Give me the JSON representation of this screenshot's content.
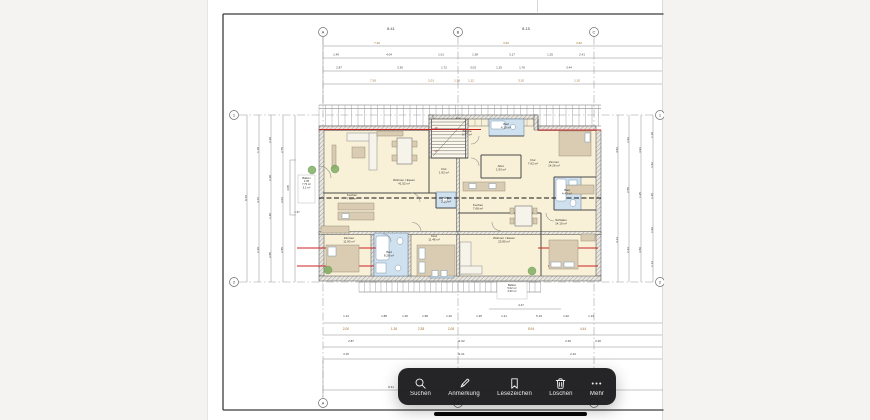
{
  "colors": {
    "background": "#f4f3f1",
    "sheet": "#ffffff",
    "toolbar": "rgba(28,28,30,0.96)",
    "accent_red": "#cc2222",
    "room_cream": "#f8f1d8",
    "bath_blue": "#cfe0ee",
    "furniture_tan": "#d9ccb2",
    "plant_green": "#7fae62",
    "dim_orange": "#a06a28"
  },
  "toolbar": {
    "buttons": [
      {
        "icon": "search-icon",
        "label": "Suchen"
      },
      {
        "icon": "pencil-icon",
        "label": "Anmerkung"
      },
      {
        "icon": "bookmark-icon",
        "label": "Lesezeichen"
      },
      {
        "icon": "trash-icon",
        "label": "Löschen"
      },
      {
        "icon": "ellipsis-icon",
        "label": "Mehr"
      }
    ]
  },
  "drawing": {
    "grid_markers": [
      {
        "x": 322,
        "y": 32,
        "t": "A"
      },
      {
        "x": 457,
        "y": 32,
        "t": "B"
      },
      {
        "x": 593,
        "y": 32,
        "t": "C"
      },
      {
        "x": 322,
        "y": 403,
        "t": "A"
      },
      {
        "x": 457,
        "y": 403,
        "t": "B"
      },
      {
        "x": 593,
        "y": 403,
        "t": "C"
      },
      {
        "x": 233,
        "y": 115,
        "t": "1"
      },
      {
        "x": 233,
        "y": 282,
        "t": "2"
      },
      {
        "x": 659,
        "y": 115,
        "t": "1"
      },
      {
        "x": 659,
        "y": 282,
        "t": "2"
      }
    ],
    "dim_rows": [
      {
        "y": 30,
        "s": 4,
        "items": [
          [
            390,
            "8.41"
          ],
          [
            525,
            "8.15"
          ]
        ]
      },
      {
        "y": 44,
        "s": 3,
        "c": "#a06a28",
        "items": [
          [
            376,
            "7.26"
          ],
          [
            505,
            "3.62"
          ],
          [
            578,
            "3.52"
          ]
        ]
      },
      {
        "y": 55.5,
        "s": 3,
        "items": [
          [
            335,
            "1.49"
          ],
          [
            388,
            "4.04"
          ],
          [
            440,
            "1.01"
          ],
          [
            474,
            "1.38"
          ],
          [
            511,
            "3.17"
          ],
          [
            549,
            "1.25"
          ],
          [
            581,
            "2.41"
          ]
        ]
      },
      {
        "y": 68.5,
        "s": 3,
        "items": [
          [
            338,
            "2.87"
          ],
          [
            399,
            "2.36"
          ],
          [
            443,
            "1.72"
          ],
          [
            472,
            "3.03"
          ],
          [
            498,
            "1.25"
          ],
          [
            521,
            "1.76"
          ],
          [
            568,
            "3.44"
          ]
        ]
      },
      {
        "y": 81.5,
        "s": 3,
        "c": "#a06a28",
        "items": [
          [
            372,
            "7.26"
          ],
          [
            430,
            "2.01"
          ],
          [
            456,
            "1.38"
          ],
          [
            470,
            "1.12"
          ],
          [
            520,
            "3.10"
          ],
          [
            576,
            "1.10"
          ]
        ]
      },
      {
        "y": 213,
        "s": 2.8,
        "items": [
          [
            296,
            "1.37"
          ]
        ]
      },
      {
        "y": 306,
        "s": 3,
        "items": [
          [
            520,
            "4.47"
          ]
        ]
      },
      {
        "y": 317,
        "s": 3,
        "items": [
          [
            345,
            "1.13"
          ],
          [
            383,
            "1.88"
          ],
          [
            404,
            "1.26"
          ],
          [
            424,
            "1.68"
          ],
          [
            448,
            "1.32"
          ],
          [
            478,
            "1.35"
          ],
          [
            503,
            "1.21"
          ],
          [
            538,
            "5.19"
          ],
          [
            565,
            "1.62"
          ],
          [
            590,
            "1.13"
          ]
        ]
      },
      {
        "y": 330,
        "s": 3.2,
        "c": "#a06a28",
        "items": [
          [
            345,
            "2.00"
          ],
          [
            393,
            "1.26"
          ],
          [
            420,
            "2.38"
          ],
          [
            450,
            "2.08"
          ],
          [
            530,
            "5.94"
          ],
          [
            582,
            "4.44"
          ]
        ]
      },
      {
        "y": 342,
        "s": 3,
        "items": [
          [
            350,
            "2.87"
          ],
          [
            460,
            "11.62"
          ],
          [
            567,
            "2.26"
          ],
          [
            597,
            "3.26"
          ]
        ]
      },
      {
        "y": 355,
        "s": 3,
        "items": [
          [
            345,
            "3.15"
          ],
          [
            460,
            "11.01"
          ],
          [
            572,
            "2.22"
          ]
        ]
      },
      {
        "y": 388,
        "s": 3,
        "items": [
          [
            390,
            "8.41"
          ]
        ]
      }
    ],
    "rotated_dims": [
      {
        "x": 246,
        "y": 198,
        "t": "8.76"
      },
      {
        "x": 258,
        "y": 150,
        "t": "1.18"
      },
      {
        "x": 258,
        "y": 200,
        "t": "4.72"
      },
      {
        "x": 258,
        "y": 250,
        "t": "2.36"
      },
      {
        "x": 270,
        "y": 140,
        "t": "2.18"
      },
      {
        "x": 270,
        "y": 178,
        "t": "2.38"
      },
      {
        "x": 270,
        "y": 216,
        "t": "1.40"
      },
      {
        "x": 270,
        "y": 255,
        "t": "2.55"
      },
      {
        "x": 282,
        "y": 150,
        "t": "2.75"
      },
      {
        "x": 282,
        "y": 200,
        "t": "2.03"
      },
      {
        "x": 282,
        "y": 250,
        "t": "2.55"
      },
      {
        "x": 288,
        "y": 188,
        "t": "4.05"
      },
      {
        "x": 617,
        "y": 150,
        "t": "4.52"
      },
      {
        "x": 617,
        "y": 240,
        "t": "4.13"
      },
      {
        "x": 628,
        "y": 140,
        "t": "1.93"
      },
      {
        "x": 628,
        "y": 190,
        "t": "2.55"
      },
      {
        "x": 628,
        "y": 250,
        "t": "2.43"
      },
      {
        "x": 640,
        "y": 150,
        "t": "3.91"
      },
      {
        "x": 640,
        "y": 195,
        "t": "1.25"
      },
      {
        "x": 640,
        "y": 250,
        "t": "3.50"
      },
      {
        "x": 652,
        "y": 135,
        "t": "1.18"
      },
      {
        "x": 652,
        "y": 165,
        "t": "1.52"
      },
      {
        "x": 652,
        "y": 196,
        "t": "1.25"
      },
      {
        "x": 652,
        "y": 230,
        "t": "1.93"
      },
      {
        "x": 652,
        "y": 264,
        "t": "1.13"
      }
    ],
    "room_labels": [
      {
        "x": 403,
        "y": 181,
        "lines": [
          "Wohnen / Essen",
          "41.52 m²"
        ]
      },
      {
        "x": 351,
        "y": 196,
        "lines": [
          "Kochen",
          "7.08 m²"
        ]
      },
      {
        "x": 466,
        "y": 132,
        "lines": [
          "Treppe",
          "3.77 m²"
        ]
      },
      {
        "x": 443,
        "y": 170,
        "lines": [
          "Flur",
          "1.92 m²"
        ]
      },
      {
        "x": 532,
        "y": 161,
        "lines": [
          "Flur",
          "7.62 m²"
        ]
      },
      {
        "x": 553,
        "y": 163,
        "lines": [
          "Zimmer",
          "14.26 m²"
        ]
      },
      {
        "x": 505,
        "y": 125,
        "lines": [
          "Bad",
          "4.10 m²"
        ]
      },
      {
        "x": 566,
        "y": 191,
        "lines": [
          "Bad",
          "4.43 m²"
        ]
      },
      {
        "x": 500,
        "y": 167,
        "lines": [
          "Abst.",
          "1.93 m²"
        ]
      },
      {
        "x": 477,
        "y": 206,
        "lines": [
          "Kochen",
          "7.68 m²"
        ]
      },
      {
        "x": 433,
        "y": 237,
        "lines": [
          "Kind",
          "11.48 m²"
        ]
      },
      {
        "x": 503,
        "y": 239,
        "lines": [
          "Wohnen / Essen",
          "23.80 m²"
        ]
      },
      {
        "x": 560,
        "y": 221,
        "lines": [
          "Schlafen",
          "14.10 m²"
        ]
      },
      {
        "x": 388,
        "y": 253,
        "lines": [
          "Bad",
          "8.28 m²"
        ]
      },
      {
        "x": 445,
        "y": 199,
        "lines": [
          "WC",
          "2.16 m²"
        ]
      },
      {
        "x": 348,
        "y": 239,
        "lines": [
          "Zimmer",
          "11.90 m²"
        ]
      }
    ],
    "boxed_labels": [
      {
        "x": 297,
        "y": 175,
        "w": 17,
        "h": 28,
        "lines": [
          "Balkon",
          "4.05",
          "7.73 m²",
          "5.2 m²"
        ]
      },
      {
        "x": 496,
        "y": 282,
        "w": 30,
        "h": 17,
        "lines": [
          "Balkon",
          "5.02 m²",
          "2.60 m²"
        ]
      }
    ],
    "red_texts": [
      {
        "x": 435,
        "y": 129,
        "t": "18"
      },
      {
        "x": 435,
        "y": 152,
        "t": "17"
      }
    ]
  }
}
